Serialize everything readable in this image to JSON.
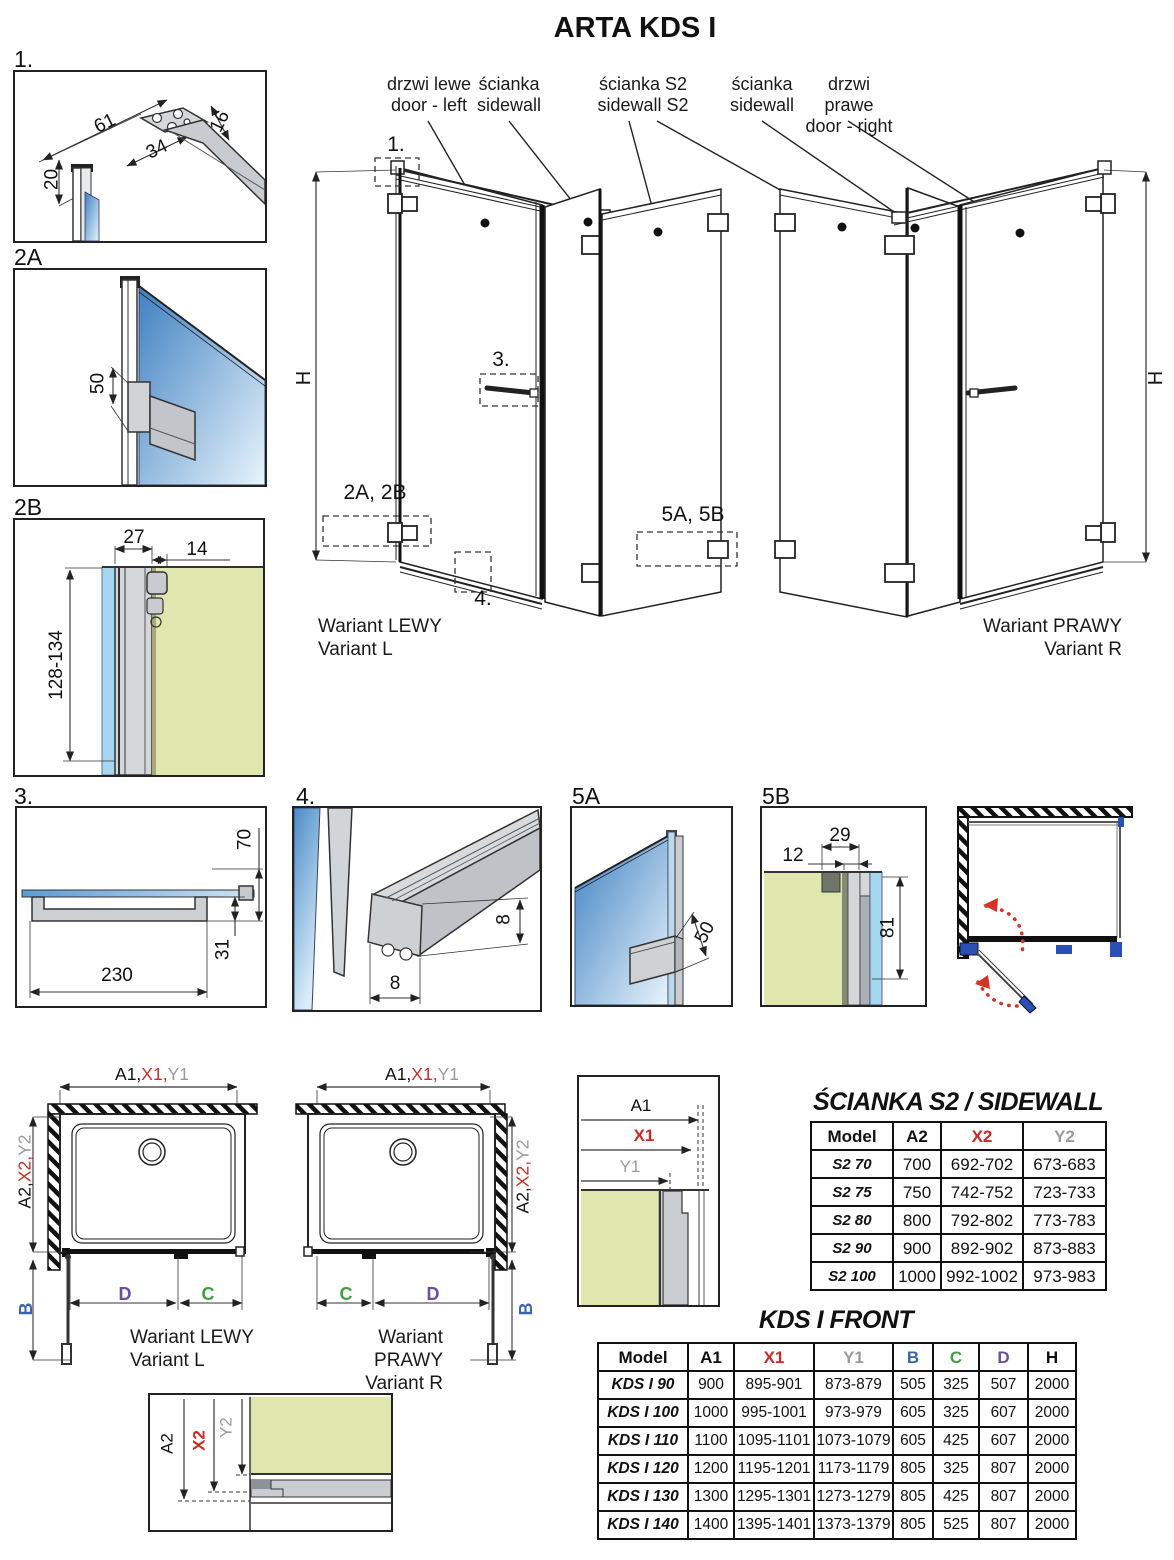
{
  "title": "ARTA KDS I",
  "top_labels": {
    "door_left": {
      "pl": "drzwi lewe",
      "en": "door - left"
    },
    "sidewall_left": {
      "pl": "ścianka",
      "en": "sidewall"
    },
    "sidewall_s2": {
      "pl": "ścianka S2",
      "en": "sidewall S2"
    },
    "sidewall_right": {
      "pl": "ścianka",
      "en": "sidewall"
    },
    "door_right": {
      "pl": "drzwi prawe",
      "en": "door - right"
    }
  },
  "variants": {
    "left": {
      "line1": "Wariant LEWY",
      "line2": "Variant L"
    },
    "right": {
      "line1": "Wariant PRAWY",
      "line2": "Variant R"
    }
  },
  "callouts": {
    "c1": "1.",
    "c2": "2A, 2B",
    "c3": "3.",
    "c4": "4.",
    "c5": "5A, 5B"
  },
  "height_label": "H",
  "details": {
    "d1": {
      "label": "1.",
      "dim_61": "61",
      "dim_34": "34",
      "dim_16": "16",
      "dim_20": "20"
    },
    "d2a": {
      "label": "2A",
      "dim_50": "50"
    },
    "d2b": {
      "label": "2B",
      "dim_27": "27",
      "dim_14": "14",
      "dim_range": "128-134"
    },
    "d3": {
      "label": "3.",
      "dim_230": "230",
      "dim_70": "70",
      "dim_31": "31"
    },
    "d4": {
      "label": "4.",
      "dim_w": "8",
      "dim_h": "8"
    },
    "d5a": {
      "label": "5A",
      "dim_50": "50"
    },
    "d5b": {
      "label": "5B",
      "dim_12": "12",
      "dim_29": "29",
      "dim_81": "81"
    }
  },
  "plan_dims": {
    "a1": "A1,",
    "x1": "X1,",
    "y1": "Y1",
    "a2": "A2,",
    "x2": "X2,",
    "y2": "Y2",
    "b": "B",
    "c": "C",
    "d": "D"
  },
  "dim_details": {
    "a1": "A1",
    "x1": "X1",
    "y1": "Y1",
    "a2": "A2",
    "x2": "X2",
    "y2": "Y2"
  },
  "s2_table": {
    "heading": "ŚCIANKA S2 / SIDEWALL S2",
    "headers": [
      {
        "label": "Model",
        "color": "#111111"
      },
      {
        "label": "A2",
        "color": "#111111"
      },
      {
        "label": "X2",
        "color": "#cc2a22"
      },
      {
        "label": "Y2",
        "color": "#9a9a9a"
      }
    ],
    "rows": [
      [
        "S2 70",
        "700",
        "692-702",
        "673-683"
      ],
      [
        "S2 75",
        "750",
        "742-752",
        "723-733"
      ],
      [
        "S2 80",
        "800",
        "792-802",
        "773-783"
      ],
      [
        "S2 90",
        "900",
        "892-902",
        "873-883"
      ],
      [
        "S2 100",
        "1000",
        "992-1002",
        "973-983"
      ]
    ]
  },
  "front_table": {
    "heading": "KDS I FRONT",
    "headers": [
      {
        "label": "Model",
        "color": "#111111"
      },
      {
        "label": "A1",
        "color": "#111111"
      },
      {
        "label": "X1",
        "color": "#cc2a22"
      },
      {
        "label": "Y1",
        "color": "#9a9a9a"
      },
      {
        "label": "B",
        "color": "#3a64ad"
      },
      {
        "label": "C",
        "color": "#3da03d"
      },
      {
        "label": "D",
        "color": "#6b4fa1"
      },
      {
        "label": "H",
        "color": "#111111"
      }
    ],
    "rows": [
      [
        "KDS I 90",
        "900",
        "895-901",
        "873-879",
        "505",
        "325",
        "507",
        "2000"
      ],
      [
        "KDS I 100",
        "1000",
        "995-1001",
        "973-979",
        "605",
        "325",
        "607",
        "2000"
      ],
      [
        "KDS I 110",
        "1100",
        "1095-1101",
        "1073-1079",
        "605",
        "425",
        "607",
        "2000"
      ],
      [
        "KDS I 120",
        "1200",
        "1195-1201",
        "1173-1179",
        "805",
        "325",
        "807",
        "2000"
      ],
      [
        "KDS I 130",
        "1300",
        "1295-1301",
        "1273-1279",
        "805",
        "425",
        "807",
        "2000"
      ],
      [
        "KDS I 140",
        "1400",
        "1395-1401",
        "1373-1379",
        "805",
        "525",
        "807",
        "2000"
      ]
    ]
  },
  "colors": {
    "red": "#cc2a22",
    "gray": "#9a9a9a",
    "blue": "#3a64ad",
    "green": "#3da03d",
    "purple": "#6b4fa1",
    "glass_blue": "#3f80c2",
    "glass_light": "#e8f4fc",
    "wall_green": "#dfe7ae",
    "profile_gray": "#c9ccd0",
    "arrow_red": "#d63327"
  }
}
